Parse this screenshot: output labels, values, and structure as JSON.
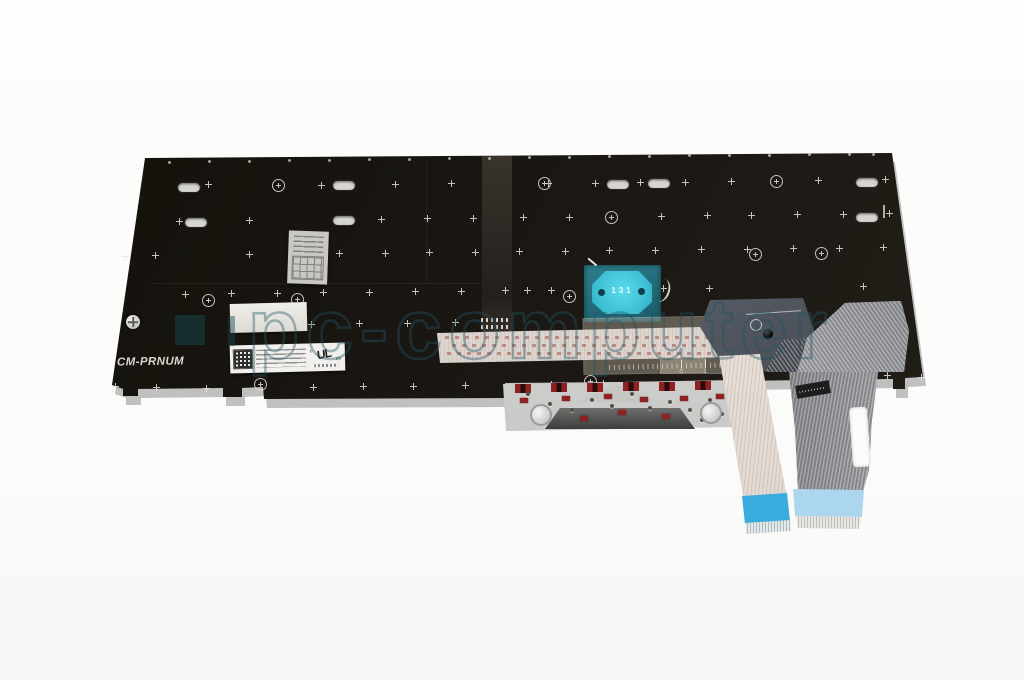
{
  "photo": {
    "watermark_text": "pc-computer",
    "plate_marking": "CM-PRNUM",
    "trackpoint_marking": "131",
    "ul_mark": {
      "prefix": "c",
      "text": "UL",
      "suffix": "us"
    },
    "ruler_numbers": [
      "0",
      "1",
      "2",
      "3",
      "4",
      "5",
      "6",
      "7",
      "8"
    ],
    "colors": {
      "plate": "#1a1714",
      "trackpoint_teal": "#46cbdd",
      "cable_blue": "#3fb0e0",
      "cable_blue_light": "#a9d8ef",
      "watermark_teal": "#235564"
    }
  },
  "markers": {
    "slot": [
      [
        178,
        183
      ],
      [
        333,
        181
      ],
      [
        607,
        180
      ],
      [
        648,
        179
      ],
      [
        856,
        178
      ],
      [
        185,
        218
      ],
      [
        333,
        216
      ],
      [
        856,
        213
      ]
    ],
    "dot": [
      [
        168,
        161
      ],
      [
        208,
        160
      ],
      [
        248,
        160
      ],
      [
        288,
        159
      ],
      [
        328,
        159
      ],
      [
        368,
        158
      ],
      [
        408,
        158
      ],
      [
        448,
        157
      ],
      [
        488,
        157
      ],
      [
        528,
        156
      ],
      [
        568,
        156
      ],
      [
        608,
        155
      ],
      [
        648,
        155
      ],
      [
        688,
        154
      ],
      [
        728,
        154
      ],
      [
        768,
        154
      ],
      [
        808,
        153
      ],
      [
        848,
        153
      ],
      [
        872,
        153
      ]
    ],
    "plus": [
      [
        205,
        181
      ],
      [
        318,
        182
      ],
      [
        392,
        181
      ],
      [
        448,
        180
      ],
      [
        545,
        180
      ],
      [
        592,
        180
      ],
      [
        637,
        179
      ],
      [
        682,
        179
      ],
      [
        728,
        178
      ],
      [
        815,
        177
      ],
      [
        882,
        176
      ],
      [
        176,
        218
      ],
      [
        246,
        217
      ],
      [
        378,
        216
      ],
      [
        424,
        215
      ],
      [
        470,
        215
      ],
      [
        520,
        214
      ],
      [
        566,
        214
      ],
      [
        658,
        213
      ],
      [
        704,
        212
      ],
      [
        748,
        212
      ],
      [
        794,
        211
      ],
      [
        840,
        211
      ],
      [
        886,
        210
      ],
      [
        122,
        253
      ],
      [
        152,
        252
      ],
      [
        246,
        251
      ],
      [
        292,
        251
      ],
      [
        336,
        250
      ],
      [
        382,
        250
      ],
      [
        426,
        249
      ],
      [
        472,
        249
      ],
      [
        516,
        248
      ],
      [
        562,
        248
      ],
      [
        606,
        247
      ],
      [
        652,
        247
      ],
      [
        698,
        246
      ],
      [
        744,
        246
      ],
      [
        790,
        245
      ],
      [
        836,
        245
      ],
      [
        880,
        244
      ],
      [
        182,
        291
      ],
      [
        228,
        290
      ],
      [
        274,
        290
      ],
      [
        320,
        289
      ],
      [
        366,
        289
      ],
      [
        412,
        288
      ],
      [
        458,
        288
      ],
      [
        502,
        287
      ],
      [
        524,
        287
      ],
      [
        548,
        287
      ],
      [
        616,
        286
      ],
      [
        660,
        285
      ],
      [
        706,
        285
      ],
      [
        860,
        283
      ],
      [
        308,
        321
      ],
      [
        356,
        320
      ],
      [
        404,
        320
      ],
      [
        452,
        319
      ],
      [
        112,
        383
      ],
      [
        153,
        384
      ],
      [
        203,
        385
      ],
      [
        310,
        384
      ],
      [
        360,
        383
      ],
      [
        410,
        383
      ],
      [
        462,
        382
      ],
      [
        548,
        381
      ],
      [
        600,
        380
      ],
      [
        884,
        372
      ],
      [
        918,
        374
      ]
    ],
    "circle": [
      [
        272,
        179
      ],
      [
        538,
        177
      ],
      [
        770,
        175
      ],
      [
        605,
        211
      ],
      [
        202,
        294
      ],
      [
        291,
        293
      ],
      [
        563,
        290
      ],
      [
        749,
        248
      ],
      [
        815,
        247
      ],
      [
        254,
        378
      ],
      [
        584,
        375
      ]
    ],
    "redclip": [
      [
        515,
        384
      ],
      [
        551,
        383
      ],
      [
        587,
        383
      ],
      [
        623,
        382
      ],
      [
        659,
        382
      ],
      [
        695,
        381
      ]
    ],
    "redbit": [
      [
        520,
        398
      ],
      [
        543,
        412
      ],
      [
        562,
        396
      ],
      [
        580,
        416
      ],
      [
        604,
        394
      ],
      [
        618,
        410
      ],
      [
        640,
        397
      ],
      [
        662,
        414
      ],
      [
        680,
        396
      ],
      [
        706,
        409
      ],
      [
        716,
        394
      ]
    ],
    "rivet": [
      [
        526,
        392
      ],
      [
        548,
        402
      ],
      [
        570,
        408
      ],
      [
        590,
        398
      ],
      [
        610,
        404
      ],
      [
        630,
        392
      ],
      [
        648,
        406
      ],
      [
        668,
        400
      ],
      [
        688,
        408
      ],
      [
        708,
        398
      ],
      [
        720,
        412
      ],
      [
        534,
        418
      ],
      [
        700,
        418
      ]
    ],
    "hub": [
      [
        530,
        404
      ],
      [
        700,
        402
      ]
    ]
  }
}
